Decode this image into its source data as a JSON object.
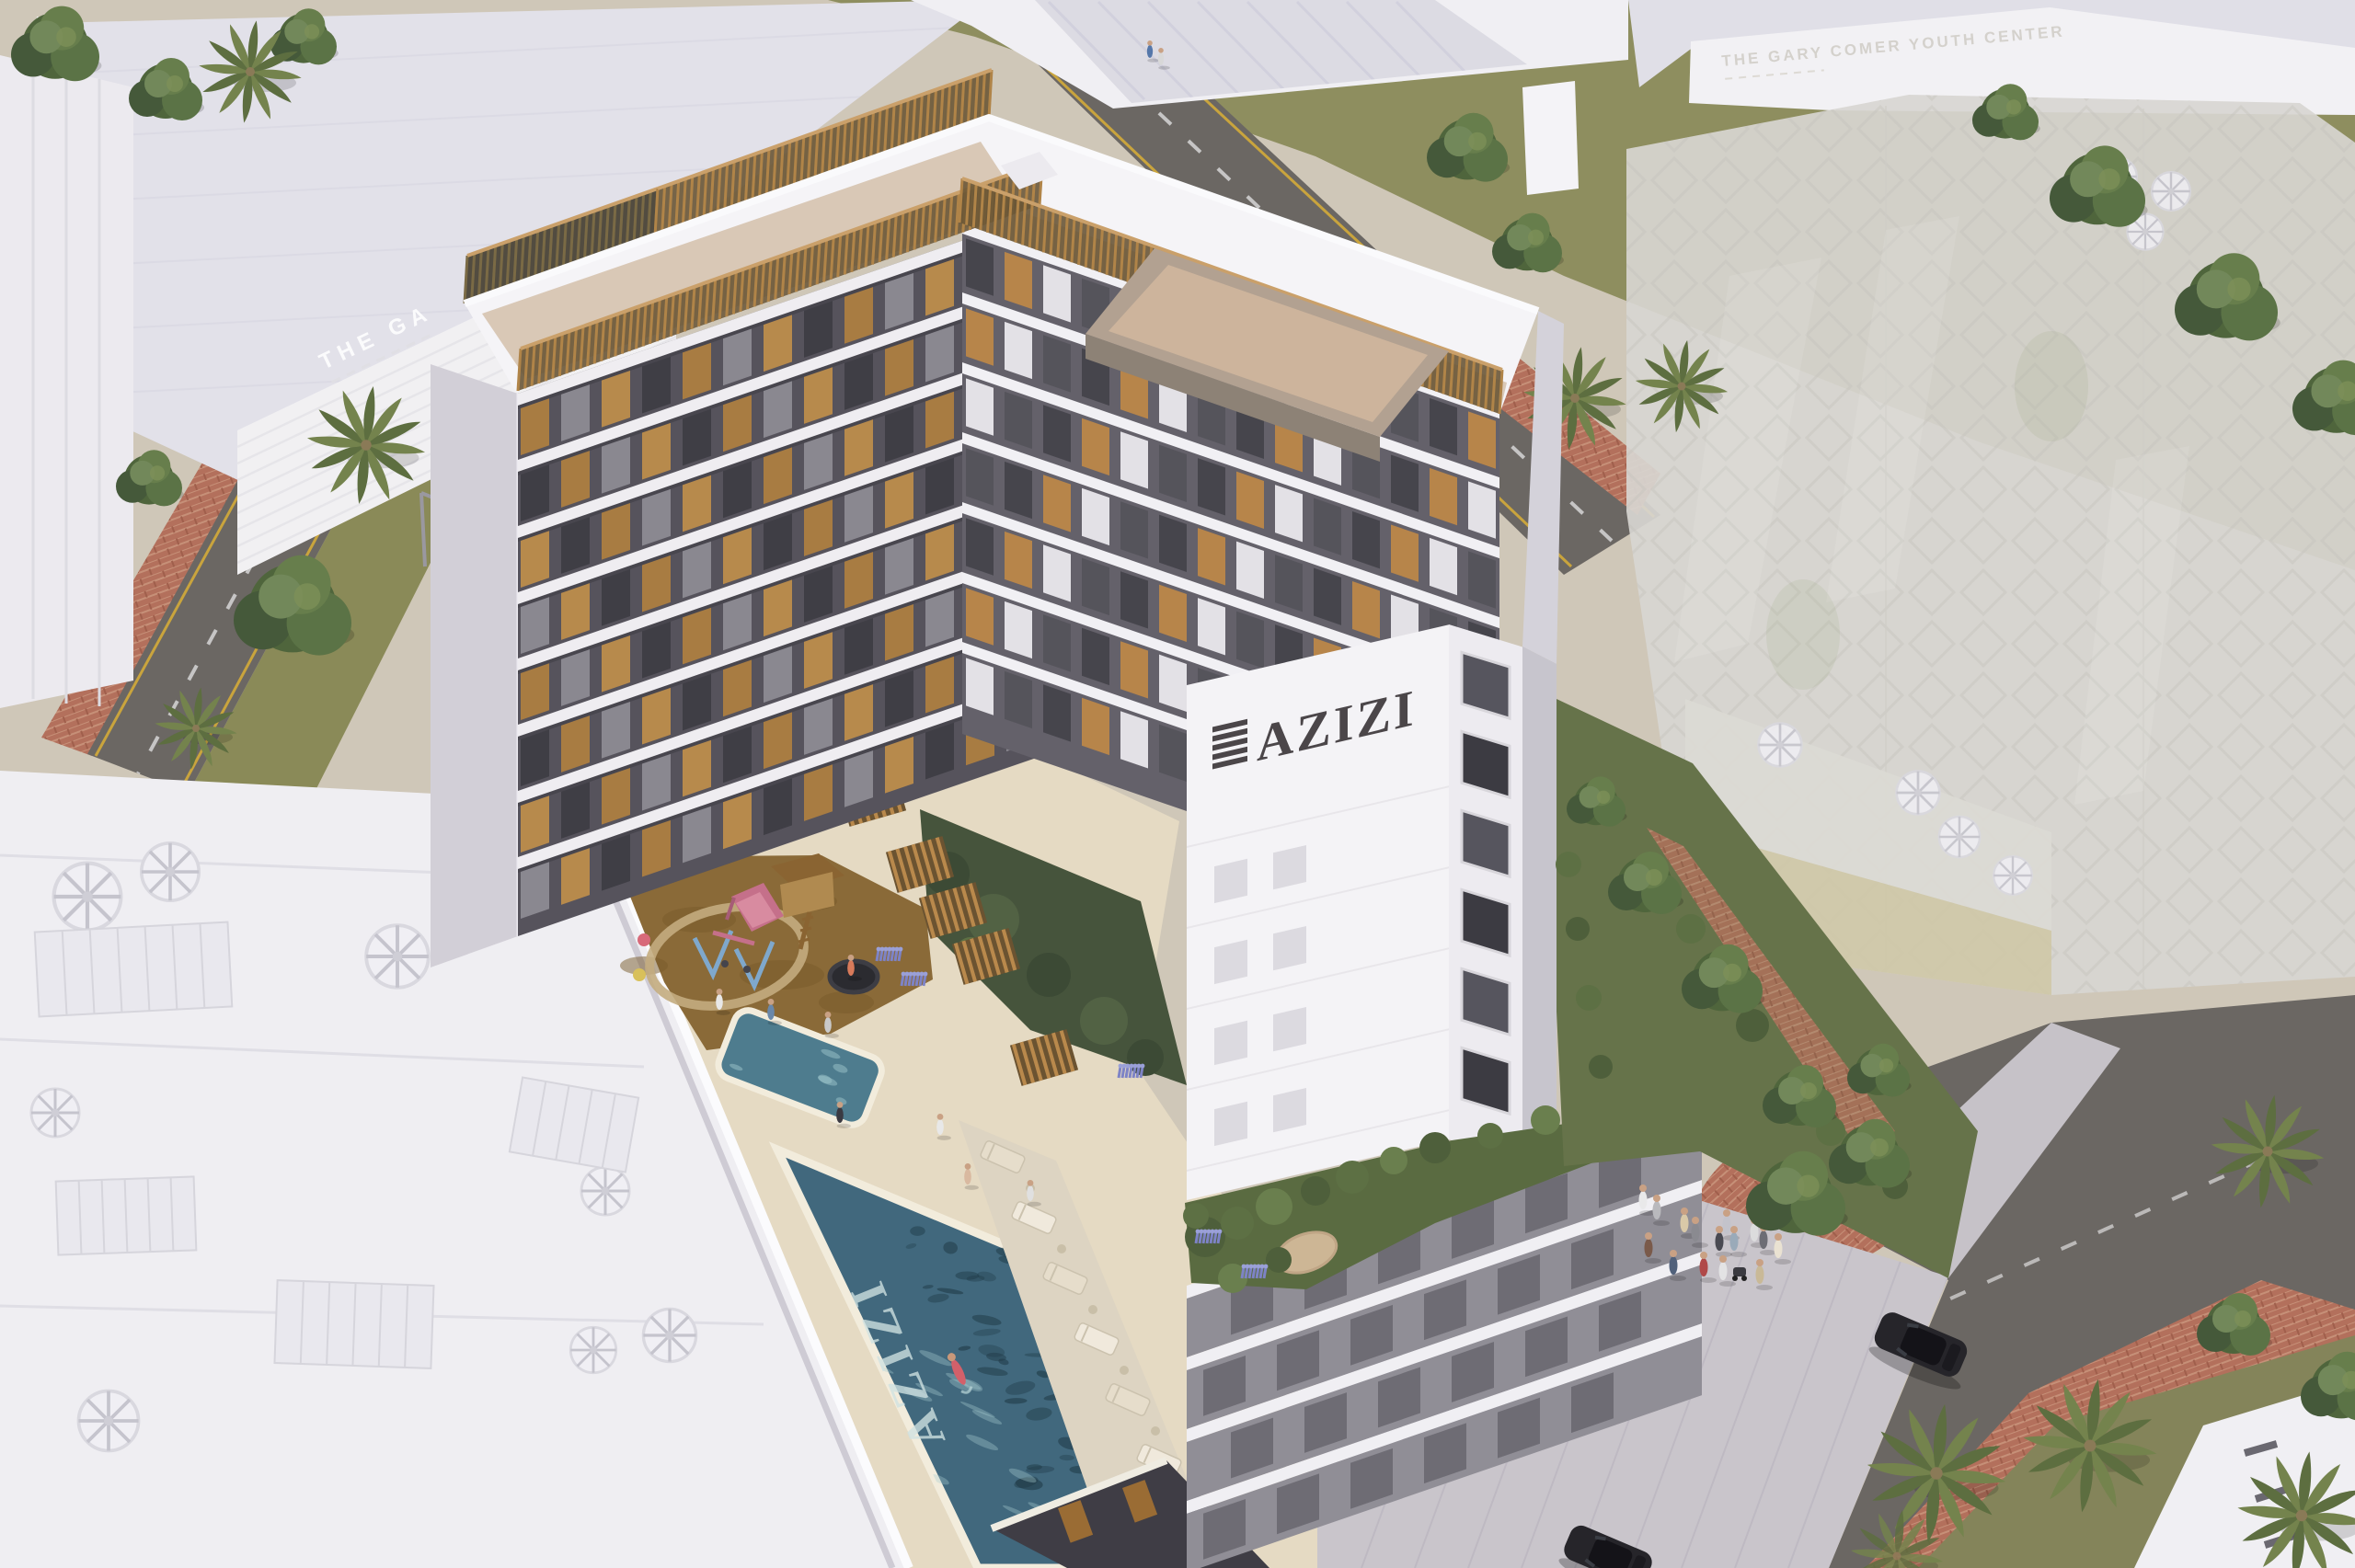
{
  "scene": {
    "description": "Aerial architectural rendering of an AZIZI residential development with courtyard playground, rooftop-podium swimming pools, landscaped streets, palm trees, pedestrians and surrounding white massing buildings",
    "texts": {
      "tower_logo": "AZIZI",
      "pool_floor_logo": "AZIZI",
      "neighbor_building_partial": "THE GA",
      "neighbor_building_far": "THE GARY COMER YOUTH CENTER"
    },
    "colors": {
      "tower_white": "#f4f3f6",
      "logo_dark": "#4b4649",
      "wood_accent": "#a9783f",
      "roof_deck_beige": "#d9c8b6",
      "penthouse_taupe": "#b2a191",
      "pool_water": "#41687d",
      "pool_water_deep": "#1f3a46",
      "deck_sand": "#e5dac3",
      "playground_brown": "#8a6a38",
      "lawn_olive": "#8e8e5f",
      "asphalt": "#6b6763",
      "brick_paving": "#b3705c",
      "sidewalk": "#c9c5cb",
      "ghost_building": "#d8d6d1",
      "palm_green": "#5f7040",
      "tree_green": "#4f653c",
      "slide_pink": "#c5708a",
      "swing_blue": "#7fa8cc",
      "car_black": "#26252a",
      "lavender": "#7d83c6"
    },
    "objects": {
      "main_building_features": [
        "rooftop terrace with timber slat screens",
        "penthouse roof box",
        "timber balcony screens",
        "inner courtyard",
        "podium arcade"
      ],
      "amenities": [
        "main swimming pool",
        "children's pool",
        "playground slide",
        "swing set",
        "timber play house",
        "trampoline",
        "sun loungers",
        "landscaped gardens",
        "timber pergolas"
      ],
      "context": [
        "white massing buildings",
        "semi-transparent planned building",
        "Gary Comer Youth Center facade",
        "asphalt streets",
        "brick sidewalks",
        "pedestrian plaza",
        "palm trees",
        "street trees",
        "pedestrians",
        "black cars"
      ],
      "counts": {
        "cars": 2,
        "pools": 2
      }
    }
  }
}
